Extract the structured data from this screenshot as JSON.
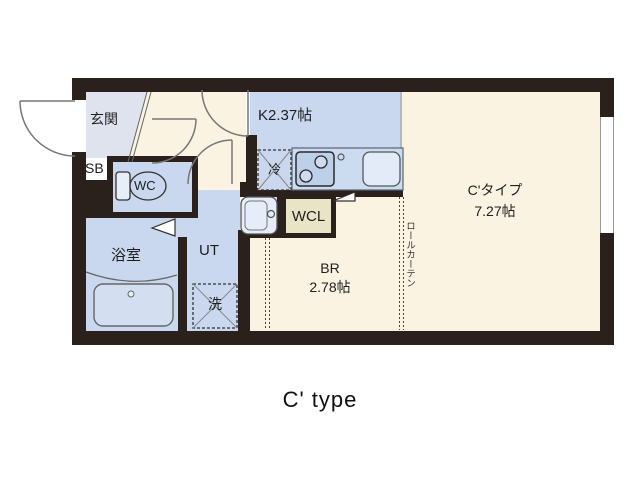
{
  "caption": "C' type",
  "rooms": {
    "entrance_label": "玄関",
    "shoebox_label": "SB",
    "toilet_label": "WC",
    "kitchen_label": "K2.37帖",
    "fridge_label": "冷",
    "bathroom_label": "浴室",
    "utility_label": "UT",
    "washer_label": "洗",
    "closet_label": "WCL",
    "bedroom_label": "BR",
    "bedroom_size": "2.78帖",
    "main_room_label": "C'タイプ",
    "main_room_size": "7.27帖",
    "roll_curtain_label": "ロールカーテン"
  },
  "colors": {
    "wall": "#2b211c",
    "floor_cream": "#faf3e1",
    "floor_blue": "#c9d8ee",
    "entrance_tile": "#dfe3ed",
    "closet_tan": "#eae4c6"
  }
}
